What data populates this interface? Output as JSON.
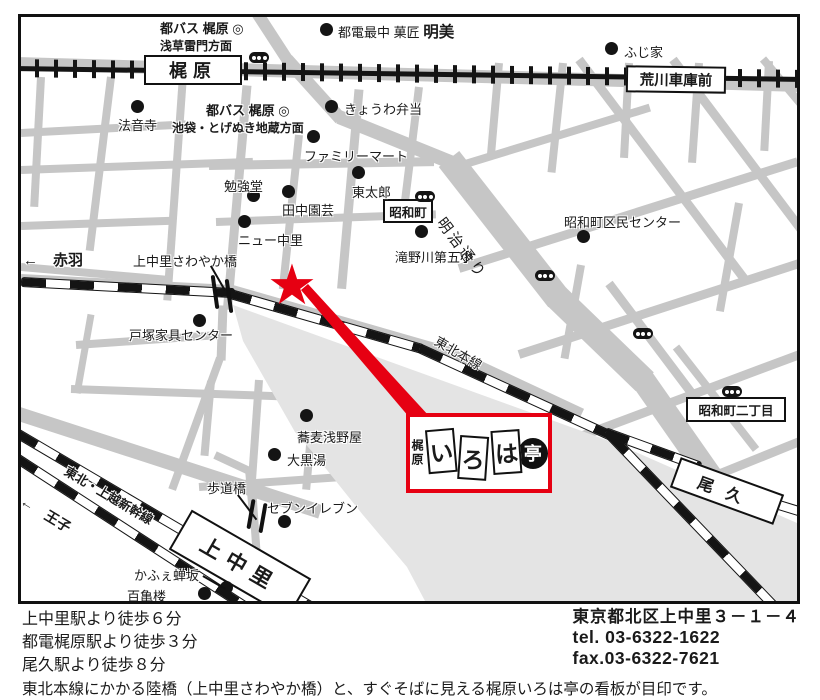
{
  "map": {
    "tram_stations": [
      {
        "label": "梶原"
      },
      {
        "label": "荒川車庫前"
      }
    ],
    "jr_stations": [
      {
        "label": "上中里"
      },
      {
        "label": "尾久"
      }
    ],
    "bus_stops": [
      {
        "line1": "都バス 梶原",
        "symbol": "◎",
        "line2": "浅草雷門方面"
      },
      {
        "line1": "都バス 梶原",
        "symbol": "◎",
        "line2": "池袋・とげぬき地蔵方面"
      }
    ],
    "area_boxes": [
      {
        "label": "昭和町"
      },
      {
        "label": "昭和町二丁目"
      }
    ],
    "road_labels": {
      "meiji": "明治通り",
      "tohoku": "東北本線",
      "shinkansen": "東北・上越新幹線"
    },
    "directions": {
      "akabane": "←　赤羽",
      "oji": "←　王子"
    },
    "bridges": {
      "sawayaka": "上中里さわやか橋",
      "hodokyo": "歩道橋"
    },
    "toden_monaka": {
      "label": "都電最中 菓匠 ",
      "em": "明美"
    },
    "pois": [
      {
        "label": "法音寺"
      },
      {
        "label": "ふじ家"
      },
      {
        "label": "きょうわ弁当"
      },
      {
        "label": "ファミリーマート"
      },
      {
        "label": "勉強堂"
      },
      {
        "label": "東太郎"
      },
      {
        "label": "田中園芸"
      },
      {
        "label": "ニュー中里"
      },
      {
        "label": "滝野川第五小"
      },
      {
        "label": "昭和町区民センター"
      },
      {
        "label": "戸塚家具センター"
      },
      {
        "label": "蕎麦浅野屋"
      },
      {
        "label": "大黒湯"
      },
      {
        "label": "セブンイレブン"
      },
      {
        "label": "かふぇ蝉坂"
      },
      {
        "label": "百亀楼"
      }
    ],
    "logo": {
      "region": "梶原",
      "cards": [
        "い",
        "ろ",
        "は"
      ],
      "tei": "亭"
    }
  },
  "footer": {
    "access": [
      "上中里駅より徒歩６分",
      "都電梶原駅より徒歩３分",
      "尾久駅より徒歩８分"
    ],
    "note": "東北本線にかかる陸橋（上中里さわやか橋）と、すぐそばに見える梶原いろは亭の看板が目印です。",
    "address": "東京都北区上中里３－１－４",
    "tel": "tel.  03-6322-1622",
    "fax": "fax.03-6322-7621"
  },
  "colors": {
    "accent": "#e60012",
    "road": "#c6c6c6",
    "yard": "#e4e4e4",
    "rail": "#141414"
  }
}
